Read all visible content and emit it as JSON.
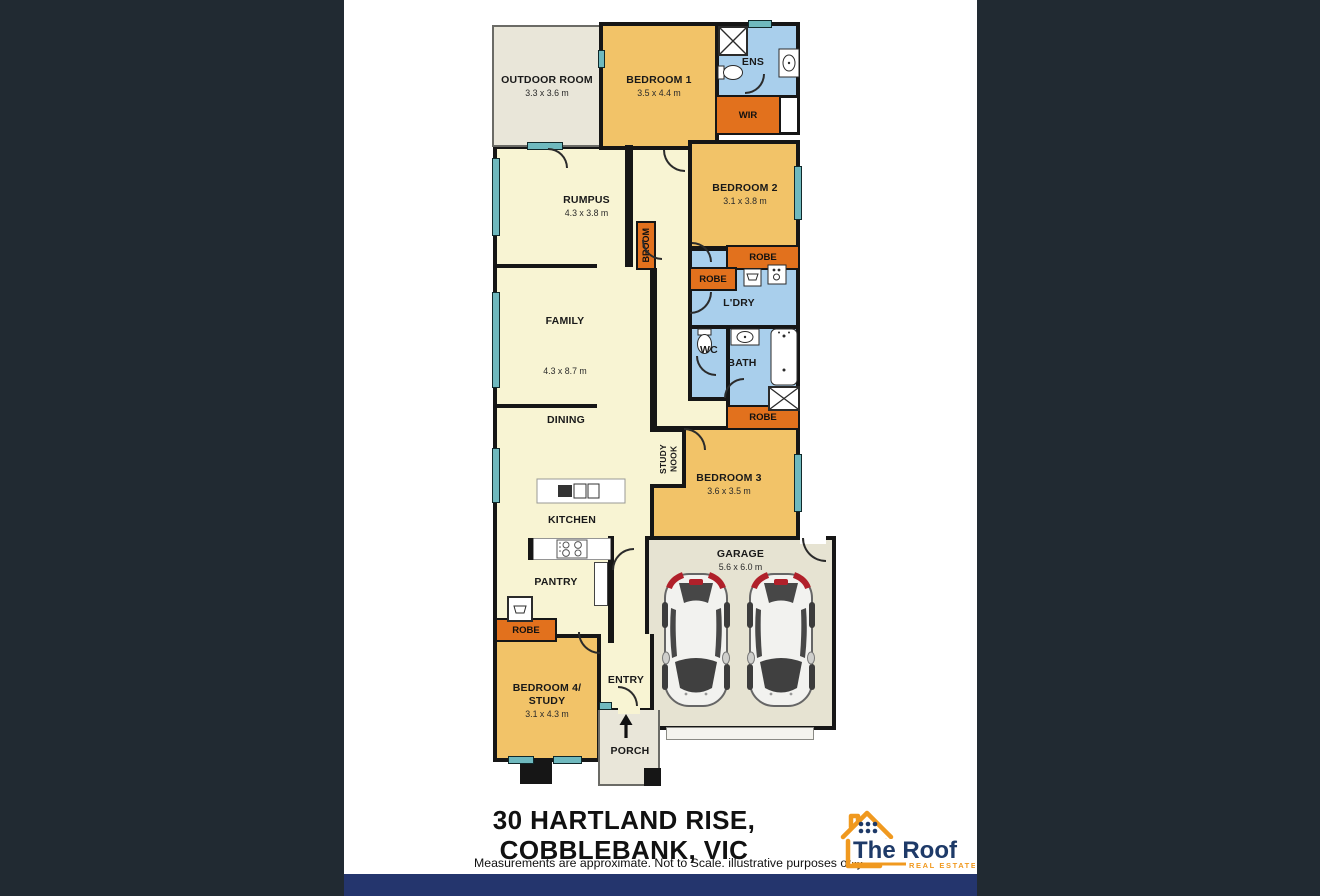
{
  "plan": {
    "rooms": {
      "outdoor": {
        "label": "OUTDOOR ROOM",
        "dims": "3.3 x 3.6 m"
      },
      "bedroom1": {
        "label": "BEDROOM 1",
        "dims": "3.5 x 4.4 m"
      },
      "ens": {
        "label": "ENS"
      },
      "wir": {
        "label": "WIR"
      },
      "rumpus": {
        "label": "RUMPUS",
        "dims": "4.3 x 3.8 m"
      },
      "bedroom2": {
        "label": "BEDROOM 2",
        "dims": "3.1 x 3.8 m"
      },
      "broom": {
        "label": "BROOM"
      },
      "robe": {
        "label": "ROBE"
      },
      "laundry": {
        "label": "L'DRY"
      },
      "family": {
        "label": "FAMILY",
        "dims": "4.3 x 8.7 m"
      },
      "wc": {
        "label": "WC"
      },
      "bath": {
        "label": "BATH"
      },
      "dining": {
        "label": "DINING"
      },
      "study_nook": {
        "label": "STUDY NOOK"
      },
      "bedroom3": {
        "label": "BEDROOM 3",
        "dims": "3.6 x 3.5 m"
      },
      "kitchen": {
        "label": "KITCHEN"
      },
      "pantry": {
        "label": "PANTRY"
      },
      "garage": {
        "label": "GARAGE",
        "dims": "5.6 x 6.0 m"
      },
      "bedroom4": {
        "label_line1": "BEDROOM 4/",
        "label_line2": "STUDY",
        "dims": "3.1 x 4.3 m"
      },
      "entry": {
        "label": "ENTRY"
      },
      "porch": {
        "label": "PORCH"
      }
    }
  },
  "footer": {
    "address_line1": "30 HARTLAND RISE,",
    "address_line2": "COBBLEBANK, VIC",
    "disclaimer": "Measurements are approximate. Not to Scale. illustrative purposes only.",
    "logo": {
      "brand": "The Roof",
      "tagline": "REAL ESTATE"
    }
  },
  "colors": {
    "wall": "#161616",
    "living": "#F8F4D3",
    "bedroom": "#F2C368",
    "wet": "#A9CFEC",
    "robe": "#E2711D",
    "outdoor": "#E9E6D9",
    "garage_floor": "#E6E3D2",
    "window": "#6FB9BE",
    "bottom_bar": "#24356D",
    "side_panel": "#212A32",
    "logo_navy": "#1E3A68",
    "logo_orange": "#F0991F"
  }
}
